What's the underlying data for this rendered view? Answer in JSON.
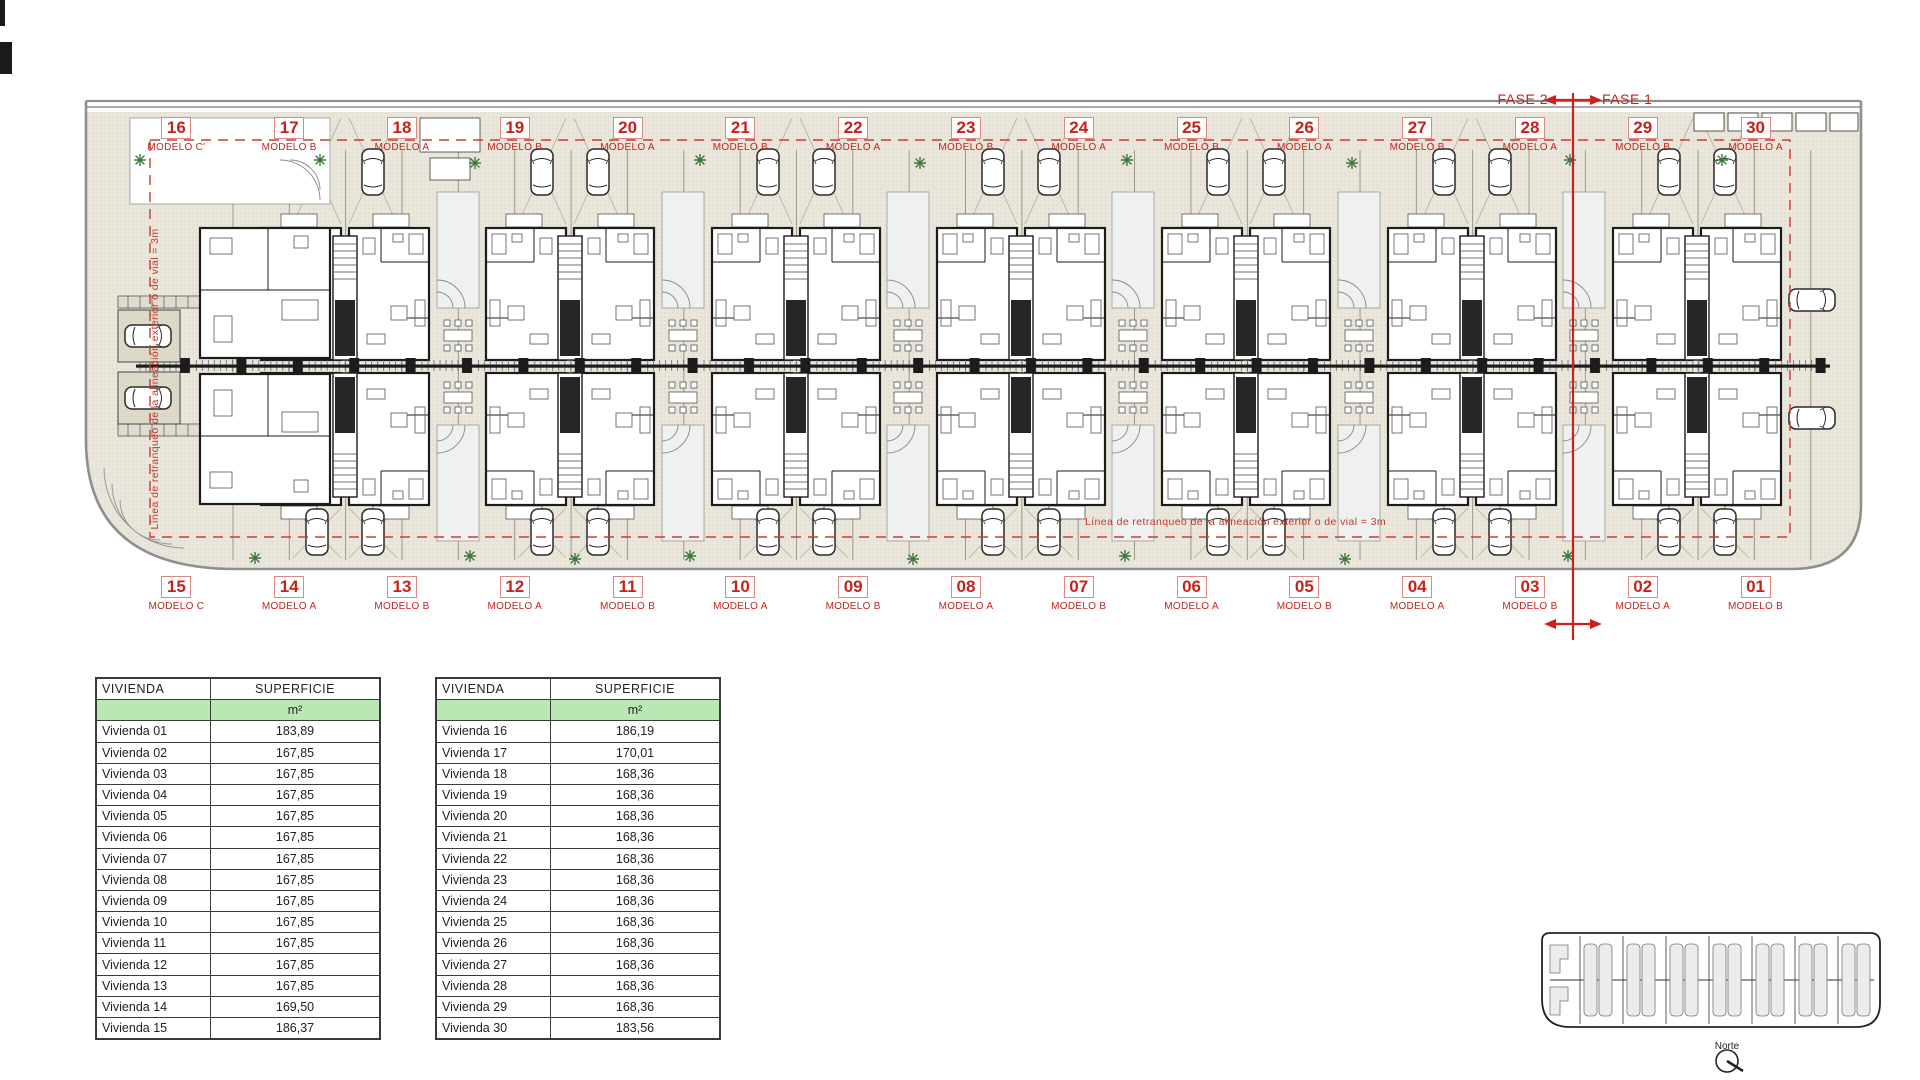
{
  "colors": {
    "accent_red": "#c2231d",
    "phase_red": "#cc1f1f",
    "paper_beige": "#eae6db",
    "boundary_gray": "#8f8f8f",
    "table_green": "#b9e8b4"
  },
  "phase": {
    "fase2_label": "FASE 2",
    "fase1_label": "FASE 1"
  },
  "plan": {
    "setback_note_left": "Línea de retranqueo de la alineación exterior o de vial = 3m",
    "setback_note_center": "Línea de retranqueo de la alineación exterior o de vial = 3m",
    "top_units": [
      {
        "number": "16",
        "modelo": "MODELO C'"
      },
      {
        "number": "17",
        "modelo": "MODELO B"
      },
      {
        "number": "18",
        "modelo": "MODELO A"
      },
      {
        "number": "19",
        "modelo": "MODELO B"
      },
      {
        "number": "20",
        "modelo": "MODELO A"
      },
      {
        "number": "21",
        "modelo": "MODELO B"
      },
      {
        "number": "22",
        "modelo": "MODELO A"
      },
      {
        "number": "23",
        "modelo": "MODELO B"
      },
      {
        "number": "24",
        "modelo": "MODELO A"
      },
      {
        "number": "25",
        "modelo": "MODELO B"
      },
      {
        "number": "26",
        "modelo": "MODELO A"
      },
      {
        "number": "27",
        "modelo": "MODELO B"
      },
      {
        "number": "28",
        "modelo": "MODELO A"
      },
      {
        "number": "29",
        "modelo": "MODELO B"
      },
      {
        "number": "30",
        "modelo": "MODELO A"
      }
    ],
    "bottom_units": [
      {
        "number": "15",
        "modelo": "MODELO C"
      },
      {
        "number": "14",
        "modelo": "MODELO A"
      },
      {
        "number": "13",
        "modelo": "MODELO B"
      },
      {
        "number": "12",
        "modelo": "MODELO A"
      },
      {
        "number": "11",
        "modelo": "MODELO B"
      },
      {
        "number": "10",
        "modelo": "MODELO A"
      },
      {
        "number": "09",
        "modelo": "MODELO B"
      },
      {
        "number": "08",
        "modelo": "MODELO A"
      },
      {
        "number": "07",
        "modelo": "MODELO B"
      },
      {
        "number": "06",
        "modelo": "MODELO A"
      },
      {
        "number": "05",
        "modelo": "MODELO B"
      },
      {
        "number": "04",
        "modelo": "MODELO A"
      },
      {
        "number": "03",
        "modelo": "MODELO B"
      },
      {
        "number": "02",
        "modelo": "MODELO A"
      },
      {
        "number": "01",
        "modelo": "MODELO B"
      }
    ]
  },
  "tables": [
    {
      "col_headers": [
        "VIVIENDA",
        "SUPERFICIE"
      ],
      "unit_label": "m²",
      "rows": [
        {
          "label": "Vivienda 01",
          "value": "183,89"
        },
        {
          "label": "Vivienda 02",
          "value": "167,85"
        },
        {
          "label": "Vivienda 03",
          "value": "167,85"
        },
        {
          "label": "Vivienda 04",
          "value": "167,85"
        },
        {
          "label": "Vivienda 05",
          "value": "167,85"
        },
        {
          "label": "Vivienda 06",
          "value": "167,85"
        },
        {
          "label": "Vivienda 07",
          "value": "167,85"
        },
        {
          "label": "Vivienda 08",
          "value": "167,85"
        },
        {
          "label": "Vivienda 09",
          "value": "167,85"
        },
        {
          "label": "Vivienda 10",
          "value": "167,85"
        },
        {
          "label": "Vivienda 11",
          "value": "167,85"
        },
        {
          "label": "Vivienda 12",
          "value": "167,85"
        },
        {
          "label": "Vivienda 13",
          "value": "167,85"
        },
        {
          "label": "Vivienda 14",
          "value": "169,50"
        },
        {
          "label": "Vivienda 15",
          "value": "186,37"
        }
      ]
    },
    {
      "col_headers": [
        "VIVIENDA",
        "SUPERFICIE"
      ],
      "unit_label": "m²",
      "rows": [
        {
          "label": "Vivienda 16",
          "value": "186,19"
        },
        {
          "label": "Vivienda 17",
          "value": "170,01"
        },
        {
          "label": "Vivienda 18",
          "value": "168,36"
        },
        {
          "label": "Vivienda 19",
          "value": "168,36"
        },
        {
          "label": "Vivienda 20",
          "value": "168,36"
        },
        {
          "label": "Vivienda 21",
          "value": "168,36"
        },
        {
          "label": "Vivienda 22",
          "value": "168,36"
        },
        {
          "label": "Vivienda 23",
          "value": "168,36"
        },
        {
          "label": "Vivienda 24",
          "value": "168,36"
        },
        {
          "label": "Vivienda 25",
          "value": "168,36"
        },
        {
          "label": "Vivienda 26",
          "value": "168,36"
        },
        {
          "label": "Vivienda 27",
          "value": "168,36"
        },
        {
          "label": "Vivienda 28",
          "value": "168,36"
        },
        {
          "label": "Vivienda 29",
          "value": "168,36"
        },
        {
          "label": "Vivienda 30",
          "value": "183,56"
        }
      ]
    }
  ],
  "compass": {
    "label": "Norte"
  }
}
